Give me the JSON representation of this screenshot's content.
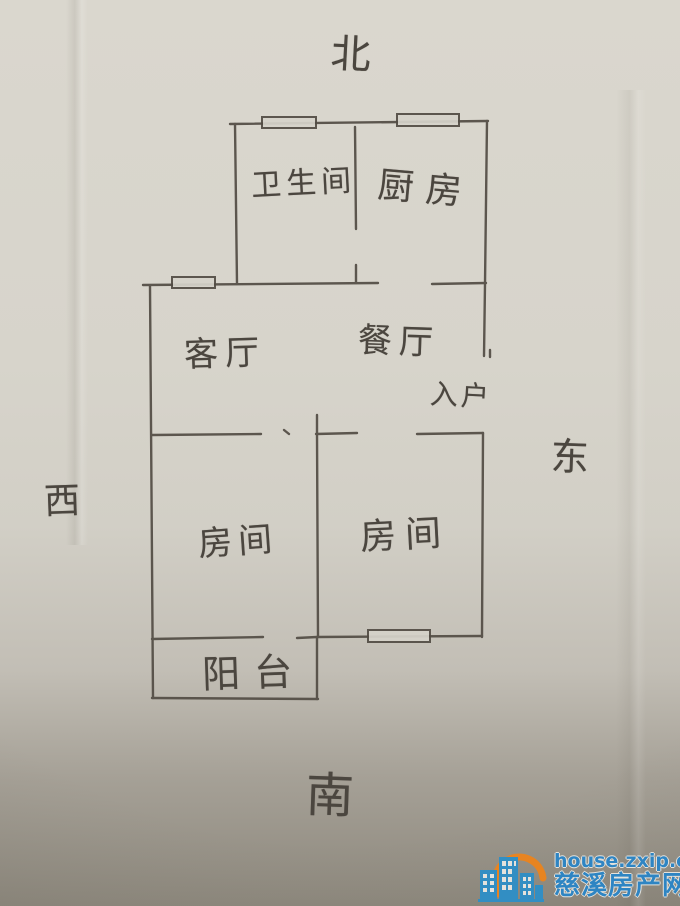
{
  "compass": {
    "north": "北",
    "south": "南",
    "east": "东",
    "west": "西"
  },
  "rooms": {
    "bathroom": "卫生间",
    "kitchen": "厨房",
    "living": "客厅",
    "dining": "餐厅",
    "entry": "入户",
    "bedroom_left": "房间",
    "bedroom_right": "房间",
    "balcony": "阳台"
  },
  "watermark": {
    "url": "house.zxip.com",
    "name": "慈溪房产网"
  },
  "style": {
    "pencil_color": "#524c44",
    "paper_color": "#d6d3ca",
    "watermark_blue": "#2b85c6",
    "watermark_orange": "#ef8418"
  }
}
